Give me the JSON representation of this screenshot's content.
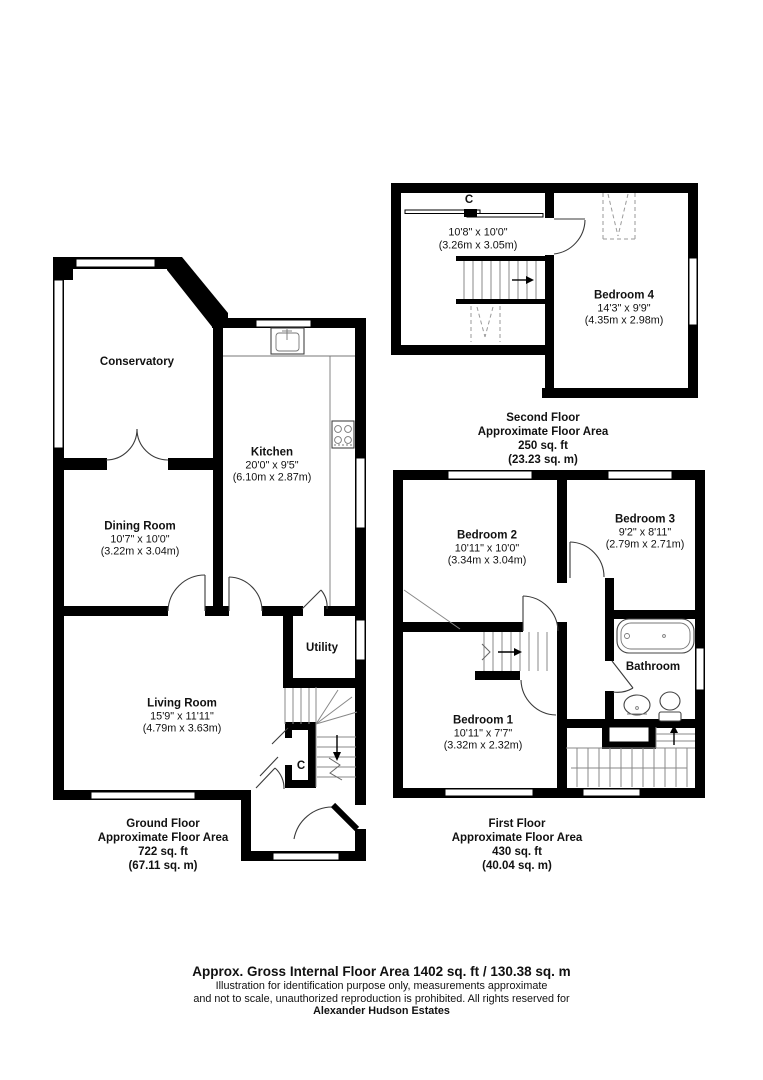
{
  "floors": {
    "ground": {
      "label": {
        "title": "Ground Floor",
        "subtitle": "Approximate Floor Area",
        "area_imperial": "722 sq. ft",
        "area_metric": "(67.11 sq. m)"
      },
      "rooms": {
        "conservatory": {
          "name": "Conservatory"
        },
        "kitchen": {
          "name": "Kitchen",
          "dims_imperial": "20'0\" x 9'5\"",
          "dims_metric": "(6.10m x 2.87m)"
        },
        "dining_room": {
          "name": "Dining Room",
          "dims_imperial": "10'7\" x 10'0\"",
          "dims_metric": "(3.22m x 3.04m)"
        },
        "living_room": {
          "name": "Living Room",
          "dims_imperial": "15'9\" x 11'11\"",
          "dims_metric": "(4.79m x 3.63m)"
        },
        "utility": {
          "name": "Utility"
        },
        "cupboard": {
          "name": "C"
        }
      }
    },
    "first": {
      "label": {
        "title": "First Floor",
        "subtitle": "Approximate Floor Area",
        "area_imperial": "430 sq. ft",
        "area_metric": "(40.04 sq. m)"
      },
      "rooms": {
        "bedroom2": {
          "name": "Bedroom 2",
          "dims_imperial": "10'11\" x 10'0\"",
          "dims_metric": "(3.34m x 3.04m)"
        },
        "bedroom3": {
          "name": "Bedroom 3",
          "dims_imperial": "9'2\" x 8'11\"",
          "dims_metric": "(2.79m x 2.71m)"
        },
        "bathroom": {
          "name": "Bathroom"
        },
        "bedroom1": {
          "name": "Bedroom 1",
          "dims_imperial": "10'11\" x 7'7\"",
          "dims_metric": "(3.32m x 2.32m)"
        }
      }
    },
    "second": {
      "label": {
        "title": "Second Floor",
        "subtitle": "Approximate Floor Area",
        "area_imperial": "250 sq. ft",
        "area_metric": "(23.23 sq. m)"
      },
      "rooms": {
        "cupboard": {
          "name": "C"
        },
        "landing": {
          "dims_imperial": "10'8\" x 10'0\"",
          "dims_metric": "(3.26m x 3.05m)"
        },
        "bedroom4": {
          "name": "Bedroom 4",
          "dims_imperial": "14'3\" x 9'9\"",
          "dims_metric": "(4.35m x 2.98m)"
        }
      }
    }
  },
  "footer": {
    "title": "Approx. Gross Internal Floor Area 1402 sq. ft / 130.38 sq. m",
    "note_line1": "Illustration for identification purpose only, measurements approximate",
    "note_line2": "and not to scale, unauthorized reproduction is prohibited. All rights reserved for",
    "company": "Alexander Hudson Estates"
  }
}
